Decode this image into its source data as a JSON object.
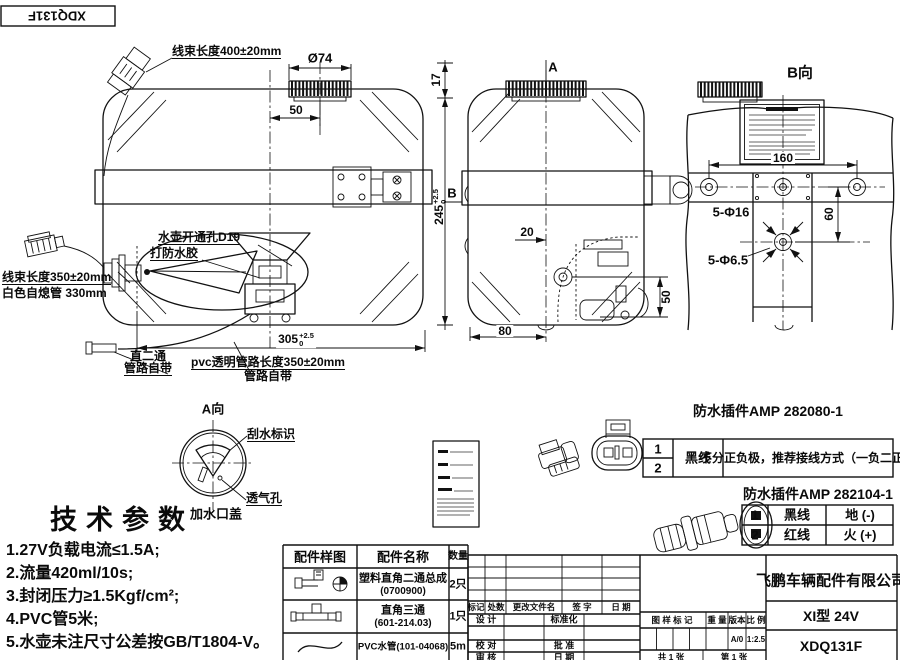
{
  "sheet": {
    "fold_label": "XDQ131F",
    "line_color": "#111111",
    "bg_color": "#ffffff"
  },
  "front_view": {
    "harness_top_label": "线束长度400±20mm",
    "cap_dia": "Ø74",
    "cap_offset_dim": "50",
    "cap_height_dim": "17",
    "height_dim": "245",
    "height_tol_up": "+2.5",
    "height_tol_dn": "0",
    "hole_label": "水壶开通孔D19",
    "seal_label": "打防水胶",
    "harness_left_label": "线束长度350±20mm",
    "tube_label": "白色自熄管 330mm",
    "fitting_label_1": "直二通",
    "fitting_label_2": "管路自带",
    "pvc_label_1": "pvc透明管路长度350±20mm",
    "pvc_label_2": "管路自带",
    "width_dim": "305",
    "width_tol_up": "+2.5",
    "width_tol_dn": "0"
  },
  "side_view": {
    "section_a": "A",
    "section_b": "B",
    "dim_20": "20",
    "dim_50": "50",
    "dim_80": "80"
  },
  "b_view": {
    "title": "B向",
    "dim_160": "160",
    "dim_60": "60",
    "holes_16": "5-Φ16",
    "holes_65": "5-Φ6.5"
  },
  "a_view": {
    "title": "A向",
    "wiper_label": "刮水标识",
    "vent_label": "透气孔",
    "cap_label": "加水口盖"
  },
  "tech_params": {
    "title": "技术参数",
    "items": [
      "1.27V负载电流≤1.5A;",
      "2.流量420ml/10s;",
      "3.封闭压力≥1.5Kgf/cm²;",
      "4.PVC管5米;",
      "5.水壶未注尺寸公差按GB/T1804-V。"
    ]
  },
  "connector1": {
    "title": "防水插件AMP 282080-1",
    "pin1": "1",
    "pin2": "2",
    "wire": "黑线",
    "note": "不分正负极，推荐接线方式（一负二正）"
  },
  "connector2": {
    "title": "防水插件AMP 282104-1",
    "rows": [
      {
        "pin": "1",
        "wire": "黑线",
        "desc": "地 (-)"
      },
      {
        "pin": "2",
        "wire": "红线",
        "desc": "火 (+)"
      }
    ]
  },
  "parts_table": {
    "headers": [
      "配件样图",
      "配件名称",
      "数量"
    ],
    "rows": [
      {
        "icon": "elbow-fitting",
        "name": "塑料直角二通总成",
        "code": "(0700900)",
        "qty": "2只"
      },
      {
        "icon": "tee-fitting",
        "name": "直角三通",
        "code": "(601-214.03)",
        "qty": "1只"
      },
      {
        "icon": "pvc-hose",
        "name": "PVC水管(101-04068)",
        "code": "",
        "qty": "5m"
      }
    ]
  },
  "title_block": {
    "company": "飞鹏车辆配件有限公司",
    "model": "XI型 24V",
    "drawing_no": "XDQ131F",
    "rev_cols": [
      "标记",
      "处数",
      "更改文件名",
      "签 字",
      "日 期"
    ],
    "design_label": "设 计",
    "standard_label": "标准化",
    "check_label": "校 对",
    "approve_label": "批 准",
    "audit_label": "审 核",
    "date_label": "日 期",
    "mark_label": "图 样 标 记",
    "weight_label": "重 量",
    "version_label": "版本",
    "scale_label": "比 例",
    "version_value": "A/0",
    "scale_value": "1:2.5",
    "sheets_total": "共 1 张",
    "sheet_index": "第 1 张"
  }
}
